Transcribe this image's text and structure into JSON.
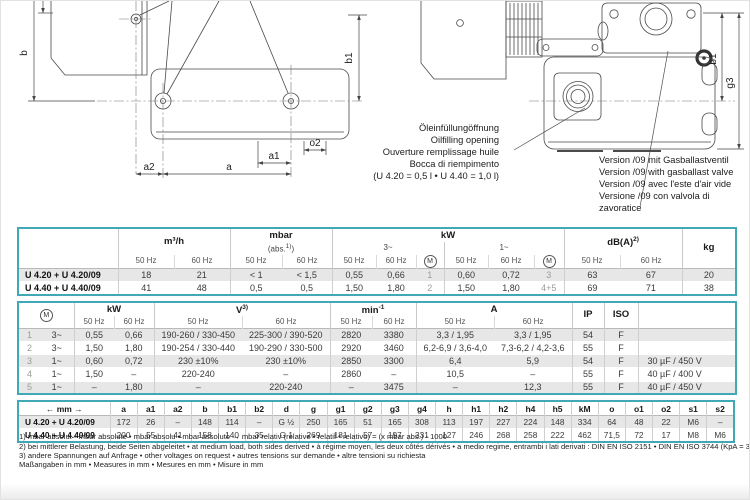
{
  "drawing": {
    "labels": {
      "b": "b",
      "b1": "b1",
      "a": "a",
      "a1": "a1",
      "a2": "a2",
      "o2": "o2",
      "g3": "g3"
    },
    "oil_note": {
      "lines": [
        "Öleinfüllungöffnung",
        "Oilfilling opening",
        "Ouverture remplissage huile",
        "Bocca di riempimento",
        "(U 4.20 = 0,5 l • U 4.40 = 1,0 l)"
      ]
    },
    "version_note": {
      "lines": [
        "Version /09 mit Gasballastventil",
        "Version /09 with gasballast valve",
        "Version /09 avec l'este d'air vide",
        "Versione /09 con valvola di zavoratice"
      ]
    }
  },
  "sym": {
    "motor": "M"
  },
  "labels": {
    "hz50": "50 Hz",
    "hz60": "60 Hz"
  },
  "t1": {
    "flow": "m³/h",
    "pressure": "mbar",
    "pressure_sub_open": "(abs.",
    "pressure_sub_sup": "1)",
    "pressure_sub_close": ")",
    "power": "kW",
    "three_phase": "3~",
    "single_phase": "1~",
    "noise_base": "dB(A)",
    "noise_sup": "2)",
    "weight": "kg",
    "rows": [
      [
        "U 4.20 + U 4.20/09",
        "18",
        "21",
        "< 1",
        "< 1,5",
        "0,55",
        "0,66",
        "1",
        "0,60",
        "0,72",
        "3",
        "63",
        "67",
        "20"
      ],
      [
        "U 4.40 + U 4.40/09",
        "41",
        "48",
        "0,5",
        "0,5",
        "1,50",
        "1,80",
        "2",
        "1,50",
        "1,80",
        "4+5",
        "69",
        "71",
        "38"
      ]
    ]
  },
  "t2": {
    "power": "kW",
    "voltage_base": "V",
    "voltage_sup": "3)",
    "speed_base": "min",
    "speed_sup": "-1",
    "current": "A",
    "ip": "IP",
    "iso": "ISO",
    "rows": [
      [
        "1",
        "3~",
        "0,55",
        "0,66",
        "190-260 / 330-450",
        "225-300 / 390-520",
        "2820",
        "3380",
        "3,3 / 1,95",
        "3,3 / 1,95",
        "54",
        "F",
        ""
      ],
      [
        "2",
        "3~",
        "1,50",
        "1,80",
        "190-254 / 330-440",
        "190-290 / 330-500",
        "2920",
        "3460",
        "6,2-6,9 / 3,6-4,0",
        "7,3-6,2 / 4,2-3,6",
        "55",
        "F",
        ""
      ],
      [
        "3",
        "1~",
        "0,60",
        "0,72",
        "230 ±10%",
        "230 ±10%",
        "2850",
        "3300",
        "6,4",
        "5,9",
        "54",
        "F",
        "30 µF / 450 V"
      ],
      [
        "4",
        "1~",
        "1,50",
        "–",
        "220-240",
        "–",
        "2860",
        "–",
        "10,5",
        "–",
        "55",
        "F",
        "40 µF / 400 V"
      ],
      [
        "5",
        "1~",
        "–",
        "1,80",
        "–",
        "220-240",
        "–",
        "3475",
        "–",
        "12,3",
        "55",
        "F",
        "40 µF / 450 V"
      ]
    ]
  },
  "t3": {
    "unit_header": "← mm →",
    "columns": [
      "a",
      "a1",
      "a2",
      "b",
      "b1",
      "b2",
      "d",
      "g",
      "g1",
      "g2",
      "g3",
      "g4",
      "h",
      "h1",
      "h2",
      "h4",
      "h5",
      "kM",
      "o",
      "o1",
      "o2",
      "s1",
      "s2"
    ],
    "rows": [
      [
        "U 4.20 + U 4.20/09",
        "172",
        "26",
        "–",
        "148",
        "114",
        "–",
        "G ½",
        "250",
        "165",
        "51",
        "165",
        "308",
        "113",
        "197",
        "227",
        "224",
        "148",
        "334",
        "64",
        "48",
        "22",
        "M6",
        "–"
      ],
      [
        "U 4.40 + U 4.40/09",
        "200",
        "55",
        "41",
        "158",
        "140",
        "35",
        "G 1",
        "269",
        "181",
        "57",
        "197",
        "331",
        "127",
        "246",
        "268",
        "258",
        "222",
        "462",
        "71,5",
        "72",
        "17",
        "M8",
        "M6"
      ]
    ]
  },
  "footnotes": [
    {
      "marker": "1)",
      "text": "mbar absolut • mbar absolute • mbar absolu • mbar assoluto  →  mbar relativ (relative • relatif • relativo) = (x mbar abs.) - 1000"
    },
    {
      "marker": "2)",
      "text": "bei mittlerer Belastung, beide Seiten abgeleitet • at medium load, both sides derived • à régime moyen, les deux côtés dérivés • a medio regime, entrambi i lati derivati :  DIN EN ISO 2151 • DIN EN ISO 3744 (KpA = 3 dB(A))"
    },
    {
      "marker": "3)",
      "text": "andere Spannungen auf Anfrage • other voltages on request • autres tensions sur demande • altre tensioni su richiesta"
    }
  ],
  "measures_note": "Maßangaben in mm • Measures in mm • Mesures en mm • Misure in mm",
  "colors": {
    "table_border": "#3fa9b5",
    "row_shade": "#e7e7e7"
  }
}
